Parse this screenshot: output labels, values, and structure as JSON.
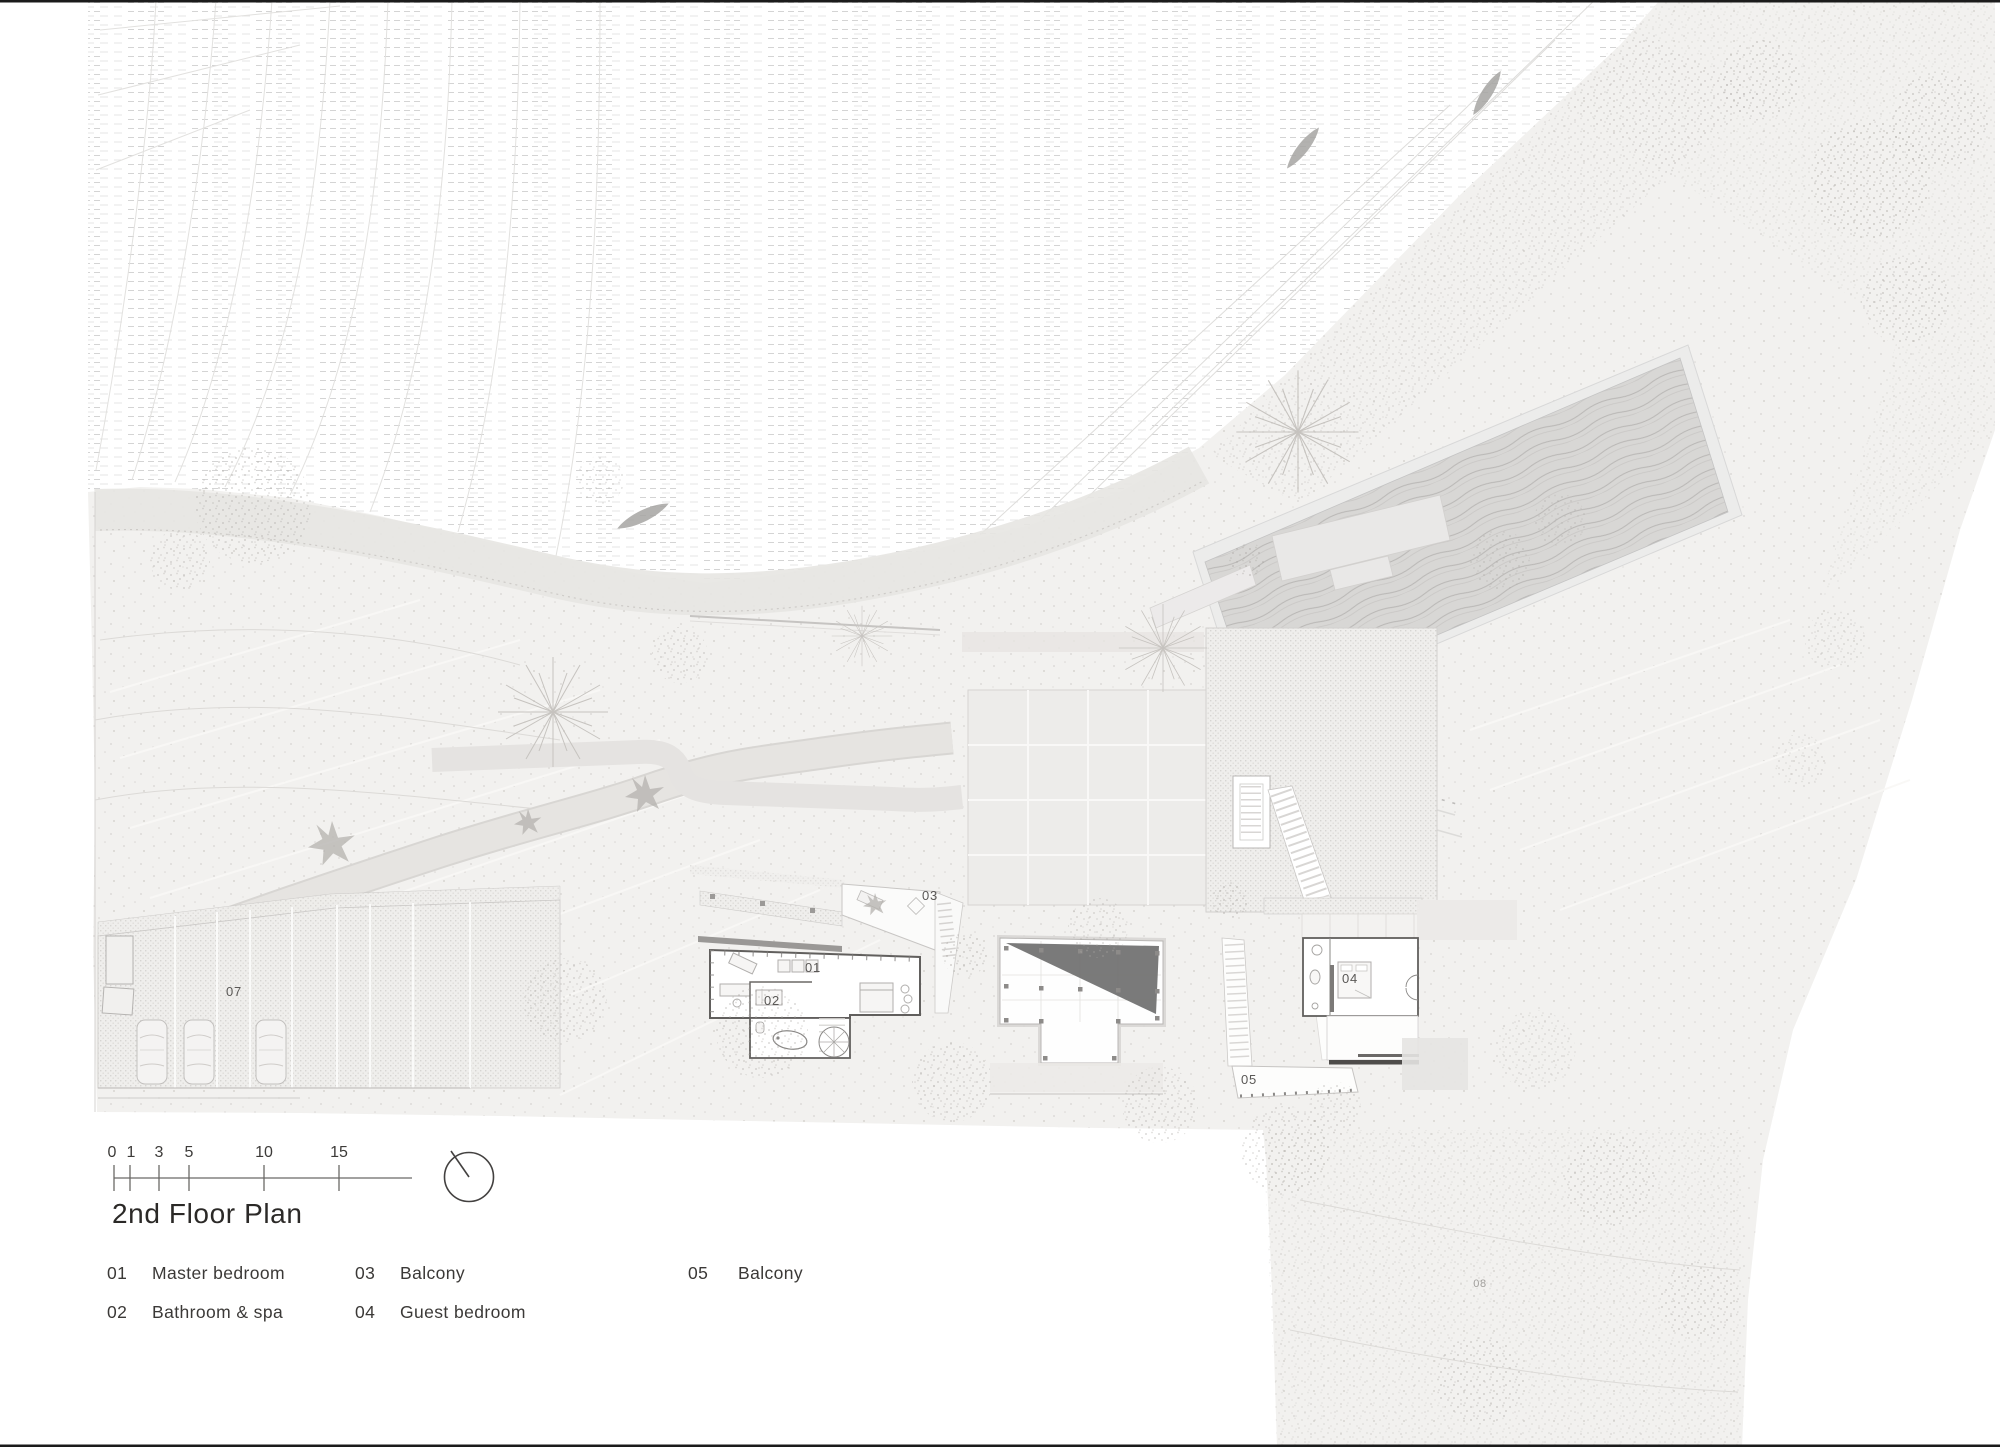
{
  "title": "2nd Floor Plan",
  "scale_bar": {
    "ticks": [
      "0",
      "1",
      "3",
      "5",
      "10",
      "15"
    ]
  },
  "north_indicator": "north-arrow",
  "plan": {
    "labels": [
      {
        "id": "01"
      },
      {
        "id": "02"
      },
      {
        "id": "03"
      },
      {
        "id": "04"
      },
      {
        "id": "05"
      },
      {
        "id": "07"
      },
      {
        "id": "08"
      }
    ]
  },
  "legend": {
    "items": [
      {
        "num": "01",
        "label": "Master bedroom"
      },
      {
        "num": "02",
        "label": "Bathroom & spa"
      },
      {
        "num": "03",
        "label": "Balcony"
      },
      {
        "num": "04",
        "label": "Guest bedroom"
      },
      {
        "num": "05",
        "label": "Balcony"
      }
    ]
  },
  "icons": [
    "north-arrow-icon",
    "boat-icon",
    "car-icon",
    "palm-tree-icon",
    "spiral-stair-icon",
    "bathtub-icon"
  ],
  "colors": {
    "paper": "#ffffff",
    "land": "#f2f1ef",
    "water_line": "#d4d4d4",
    "pool_water": "#d8d7d5",
    "roof_shadow": "#6f6f6f",
    "ink": "#2b2927",
    "frame": "#1b1b1b"
  }
}
